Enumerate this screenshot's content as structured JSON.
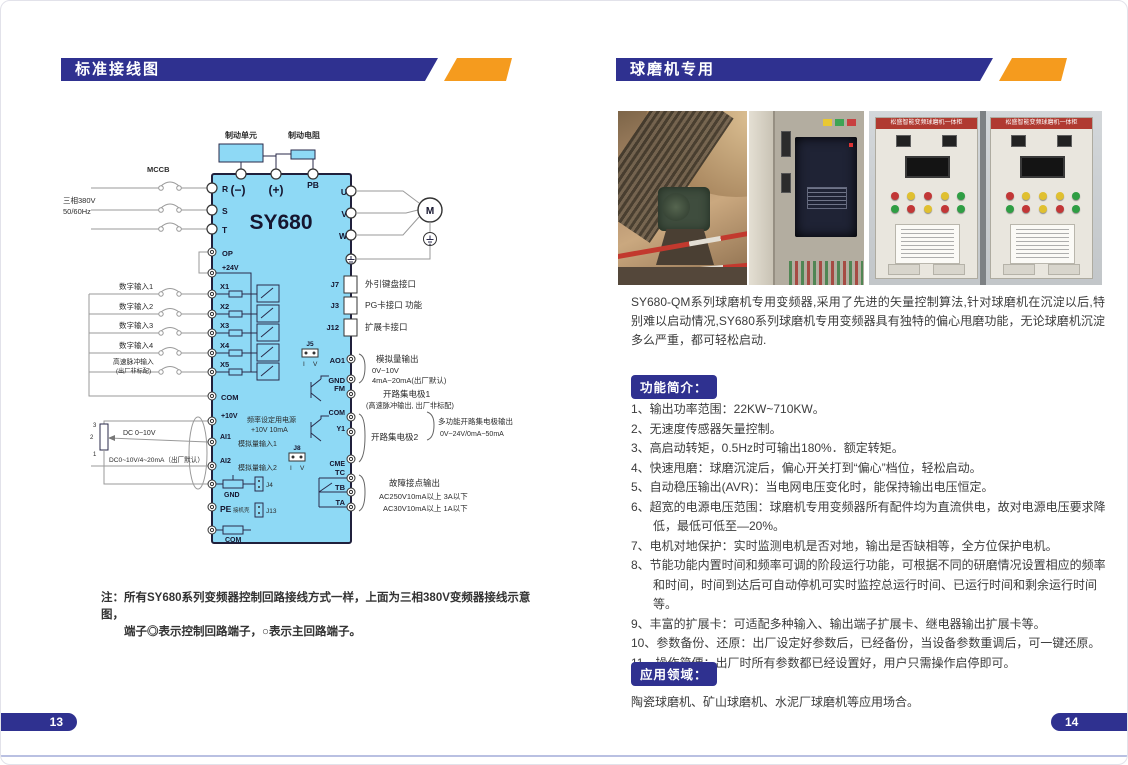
{
  "colors": {
    "accent_blue": "#2f3190",
    "accent_orange": "#f59b1e",
    "diagram_blue": "#8ed9f5"
  },
  "left_page": {
    "header": "标准接线图",
    "page_number": "13",
    "note": {
      "line1": "注：所有SY680系列变频器控制回路接线方式一样，上面为三相380V变频器接线示意图，",
      "line2": "端子◎表示控制回路端子，○表示主回路端子。"
    },
    "diagram": {
      "model": "SY680",
      "brake_unit": "制动单元",
      "brake_resistor": "制动电阻",
      "mccb": "MCCB",
      "supply_l1": "三相380V",
      "supply_l2": "50/60Hz",
      "minus": "(−)",
      "plus": "(+)",
      "pb": "PB",
      "r": "R",
      "s": "S",
      "t": "T",
      "u": "U",
      "v": "V",
      "w": "W",
      "op": "OP",
      "v24": "+24V",
      "x1": "X1",
      "x2": "X2",
      "x3": "X3",
      "x4": "X4",
      "x5": "X5",
      "com": "COM",
      "v10": "+10V",
      "freq1": "频率设定用电源",
      "freq2": "+10V 10mA",
      "ai1": "AI1",
      "ai1_label": "模拟量输入1",
      "ai2": "AI2",
      "ai2_label": "模拟量输入2",
      "di1": "数字输入1",
      "di2": "数字输入2",
      "di3": "数字输入3",
      "di4": "数字输入4",
      "pulse1": "高速脉冲输入",
      "pulse2": "(出厂非标配)",
      "dc1": "DC 0~10V",
      "dc2": "DC0~10V/4~20mA（出厂默认）",
      "pot3": "3",
      "pot2": "2",
      "pot1": "1",
      "gnd": "GND",
      "j4": "J4",
      "pe": "PE",
      "pe_note": "接机壳",
      "j13": "J13",
      "com_b": "COM",
      "j7": "J7",
      "j3": "J3",
      "j12": "J12",
      "port_keyboard": "外引键盘接口",
      "port_pg": "PG卡接口 功能",
      "port_exp": "扩展卡接口",
      "j5": "J5",
      "j8": "J8",
      "sw_i": "I",
      "sw_v": "V",
      "ao1": "AO1",
      "gnd2": "GND",
      "aout1": "模拟量输出",
      "aout2": "0V~10V",
      "aout3": "4mA~20mA(出厂默认)",
      "fm": "FM",
      "oc1": "开路集电极1",
      "oc1b": "(高速脉冲输出, 出厂非标配)",
      "com3": "COM",
      "y1": "Y1",
      "cme": "CME",
      "oc2": "开路集电极2",
      "multi1": "多功能开路集电极输出",
      "multi2": "0V~24V/0mA~50mA",
      "tc": "TC",
      "tb": "TB",
      "ta": "TA",
      "fault1": "故障接点输出",
      "fault2": "AC250V10mA以上 3A以下",
      "fault3": "AC30V10mA以上 1A以下",
      "motor_m": "M"
    }
  },
  "right_page": {
    "header": "球磨机专用",
    "page_number": "14",
    "cabinet_banner": "松盛智能变频球磨机一体柜",
    "intro": "SY680-QM系列球磨机专用变频器,采用了先进的矢量控制算法,针对球磨机在沉淀以后,特别难以启动情况,SY680系列球磨机专用变频器具有独特的偏心甩磨功能，无论球磨机沉淀多么严重，都可轻松启动.",
    "features_title": "功能简介：",
    "features": [
      "1、输出功率范围：22KW~710KW。",
      "2、无速度传感器矢量控制。",
      "3、高启动转矩，0.5Hz时可输出180%．额定转矩。",
      "4、快速甩磨：球磨沉淀后，偏心开关打到“偏心”档位，轻松启动。",
      "5、自动稳压输出(AVR)：当电网电压变化时，能保持输出电压恒定。",
      "6、超宽的电源电压范围：球磨机专用变频器所有配件均为直流供电，故对电源电压要求降低，最低可低至—20%。",
      "7、电机对地保护：实时监测电机是否对地，输出是否缺相等，全方位保护电机。",
      "8、节能功能内置时间和频率可调的阶段运行功能，可根据不同的研磨情况设置相应的频率和时间，时间到达后可自动停机可实时监控总运行时间、已运行时间和剩余运行时间等。",
      "9、丰富的扩展卡：可适配多种输入、输出端子扩展卡、继电器输出扩展卡等。",
      "10、参数备份、还原：出厂设定好参数后，已经备份，当设备参数重调后，可一键还原。",
      "11、操作简便：出厂时所有参数都已经设置好，用户只需操作启停即可。"
    ],
    "applications_title": "应用领域：",
    "applications_text": "陶瓷球磨机、矿山球磨机、水泥厂球磨机等应用场合。"
  }
}
